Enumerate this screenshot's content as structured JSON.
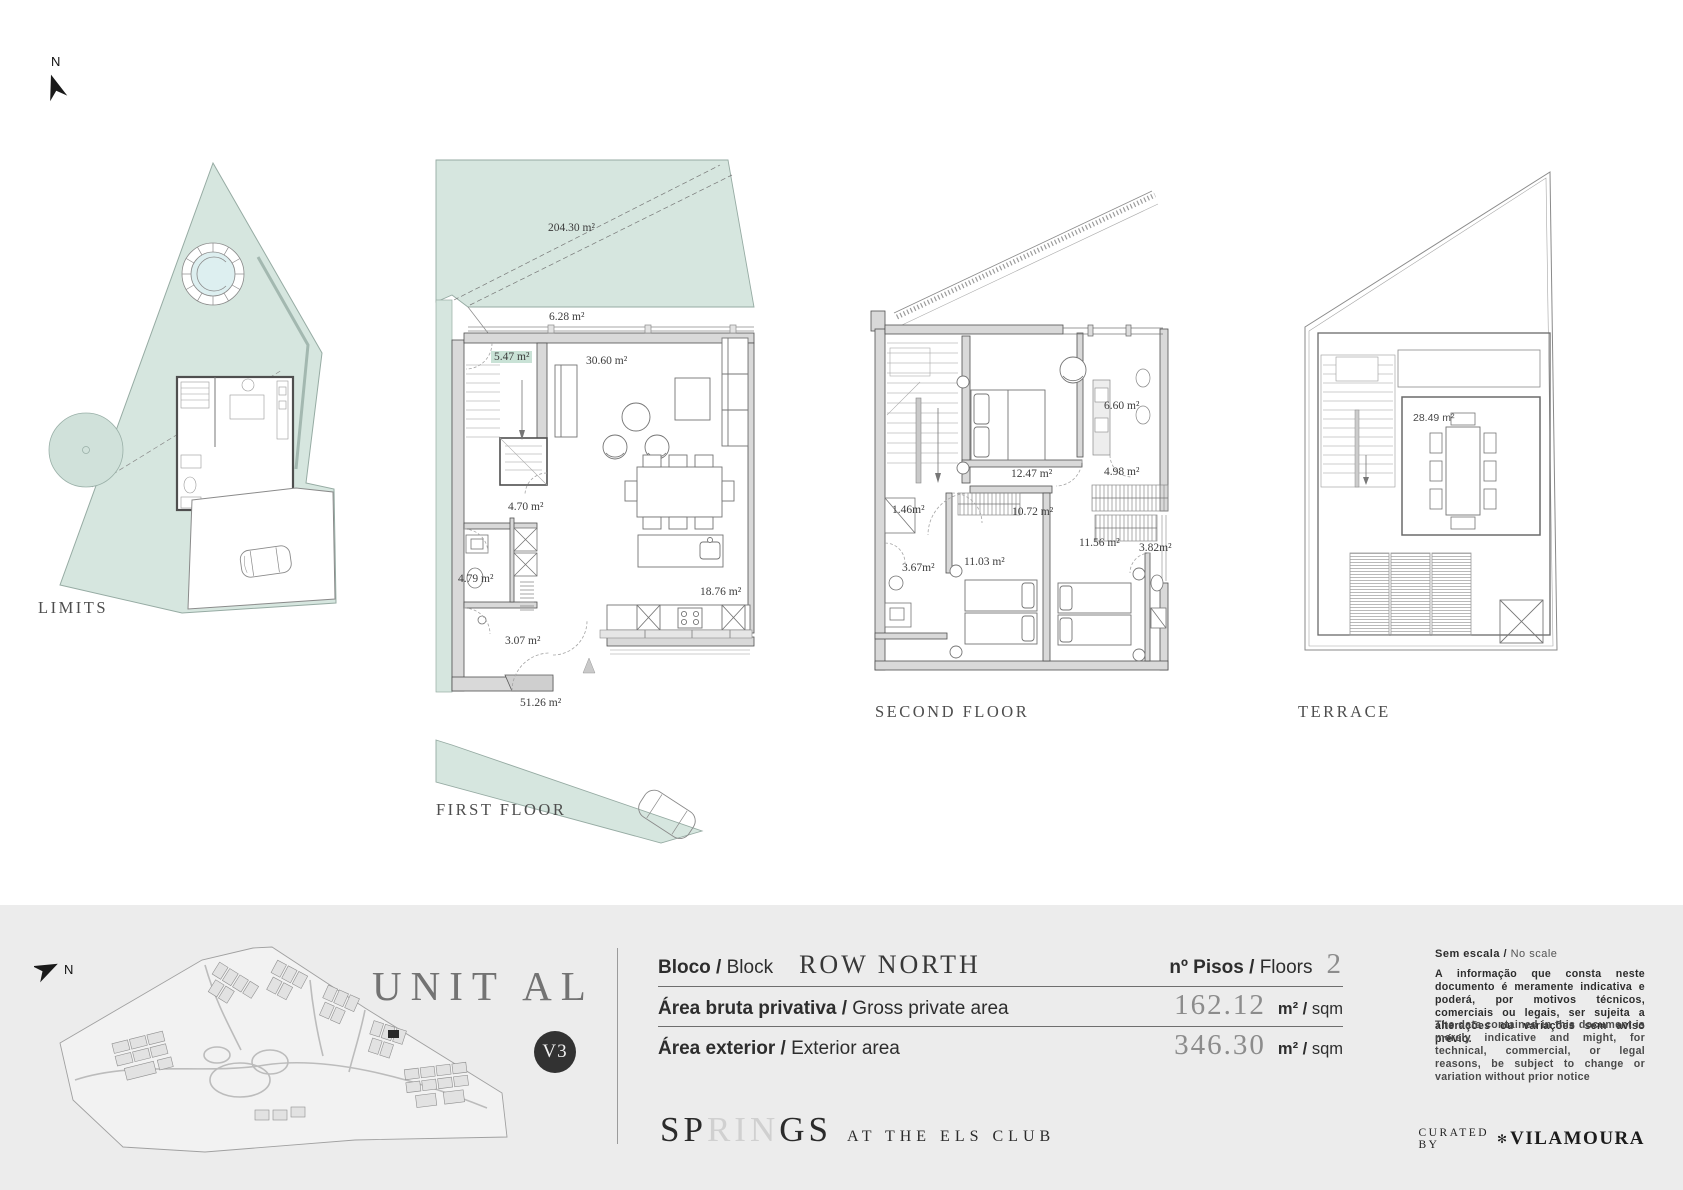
{
  "north": {
    "label": "N"
  },
  "plans": {
    "limits": {
      "title": "LIMITS"
    },
    "first_floor": {
      "title": "FIRST FLOOR",
      "garden": "204.30 m²",
      "balcony": "6.28 m²",
      "stairs": "5.47 m²",
      "living": "30.60 m²",
      "hall": "4.70 m²",
      "bath": "4.79 m²",
      "entry": "3.07 m²",
      "kitchen": "18.76 m²",
      "patio": "51.26 m²"
    },
    "second_floor": {
      "title": "SECOND FLOOR",
      "bath_top": "6.60 m²",
      "bedroom_main": "12.47 m²",
      "closet": "4.98 m²",
      "landing": "1.46m²",
      "hall": "10.72 m²",
      "wardrobe": "11.56 m²",
      "bath_right": "3.82m²",
      "bath_left": "3.67m²",
      "bedroom_2": "11.03 m²"
    },
    "terrace": {
      "title": "TERRACE",
      "roof": "28.49 m²"
    }
  },
  "footer": {
    "unit_title": "UNIT AL",
    "version": "V3",
    "rows": {
      "block_pt": "Bloco / ",
      "block_en": "Block",
      "block_value": "ROW NORTH",
      "floors_pt": "nº Pisos / ",
      "floors_en": "Floors",
      "floors_value": "2",
      "gross_pt": "Área bruta privativa / ",
      "gross_en": "Gross private area",
      "gross_value": "162.12",
      "gross_unit_pt": "m² / ",
      "gross_unit_en": "sqm",
      "ext_pt": "Área exterior / ",
      "ext_en": "Exterior area",
      "ext_value": "346.30",
      "ext_unit_pt": "m² / ",
      "ext_unit_en": "sqm"
    },
    "brand": {
      "p1": "SP",
      "p2": "RIN",
      "p3": "GS",
      "tail": "AT THE ELS CLUB"
    },
    "notes": {
      "scale_pt": "Sem escala / ",
      "scale_en": "No scale",
      "pt": "A informação que consta neste documento é meramente indicativa e poderá, por motivos técnicos, comerciais ou legais, ser sujeita a alterações ou variações sem aviso prévio.",
      "en": "The data contained in this document is merely indicative and might, for technical, commercial, or legal reasons, be subject to change or variation without prior notice"
    },
    "curated": {
      "label": "CURATED BY",
      "glyph": "✻",
      "brand": "VILAMOURA"
    }
  }
}
